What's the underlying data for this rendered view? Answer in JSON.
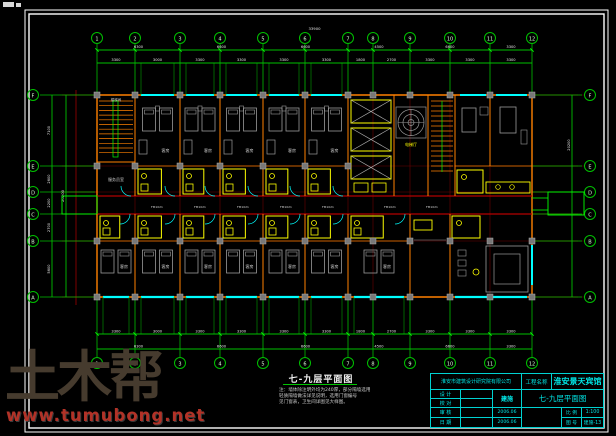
{
  "colors": {
    "grid_green": "#00c000",
    "bright_green": "#00ff00",
    "wall_orange": "#ff8000",
    "axis_red": "#b40000",
    "dark_red": "#6e0000",
    "window_cyan": "#00ffff",
    "fixture_yellow": "#ffff00",
    "furniture_gray": "#9a9a9a",
    "dim_text_white": "#e8e8e8",
    "titleblock_cyan": "#00e6e6",
    "frame_white": "#ffffff"
  },
  "watermark": {
    "logo": "土木帮",
    "url": "www.tumubong.net"
  },
  "drawing": {
    "title": "七-九层平面图",
    "notes": [
      "注：墙体除注明外均为240厚，部分隔墙选用",
      "轻质隔墙做法详见说明，选用门窗编号",
      "见门窗表，卫生间详图见大样图。"
    ],
    "room_label": "客房",
    "stair_label": "楼梯间",
    "service_label": "服务员室",
    "lobby_label": "电梯厅",
    "door_label": "FM1021",
    "axes_top": [
      "1",
      "2",
      "3",
      "4",
      "5",
      "6",
      "7",
      "8",
      "9",
      "10",
      "11",
      "12"
    ],
    "axes_left": [
      "F",
      "E",
      "D",
      "C",
      "B",
      "A"
    ],
    "dims_top": [
      "3300",
      "3000",
      "3300",
      "3300",
      "3300",
      "3300",
      "1800",
      "2700",
      "3300",
      "3300",
      "3300"
    ],
    "dims_top_major": [
      "6300",
      "6600",
      "6600",
      "4500",
      "6600",
      "3300"
    ],
    "dims_left": [
      "7100",
      "2600",
      "2200",
      "2700",
      "5600"
    ],
    "overall_top": "33900",
    "overall_left": "20200"
  },
  "titleblock": {
    "institute": "淮安市建筑设计研究院有限公司",
    "project_label": "工程名称",
    "project_name": "淮安景天宾馆",
    "row_labels": [
      "设 计",
      "校 对",
      "审 核",
      "日 期"
    ],
    "category": "建施",
    "date1": "2006.06",
    "date2": "2006.06",
    "sheet_title": "七-九层平面图",
    "scale_label": "比 例",
    "scale_value": "1:100",
    "no_label": "图 号",
    "no_value": "建施-13"
  }
}
